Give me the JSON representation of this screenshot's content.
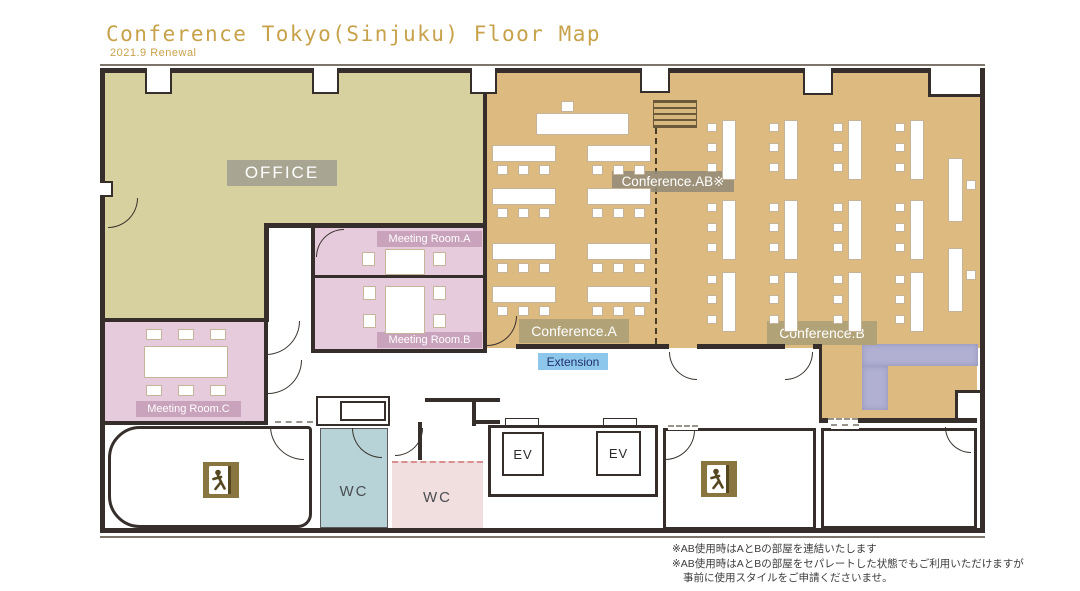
{
  "header": {
    "title": "Conference Tokyo(Sinjuku) Floor Map",
    "subtitle": "2021.9 Renewal"
  },
  "rooms": {
    "office": {
      "label": "OFFICE"
    },
    "conference_ab": {
      "label": "Conference.AB※"
    },
    "conference_a": {
      "label": "Conference.A"
    },
    "conference_b": {
      "label": "Conference.B"
    },
    "extension": {
      "label": "Extension"
    },
    "meeting_room_a": {
      "label": "Meeting Room.A"
    },
    "meeting_room_b": {
      "label": "Meeting Room.B"
    },
    "meeting_room_c": {
      "label": "Meeting Room.C"
    },
    "wc_left": {
      "label": "WC"
    },
    "wc_right": {
      "label": "WC"
    },
    "elevator_1": {
      "label": "EV"
    },
    "elevator_2": {
      "label": "EV"
    }
  },
  "notes": {
    "line1": "※AB使用時はAとBの部屋を連結いたします",
    "line2": "※AB使用時はAとBの部屋をセパレートした状態でもご利用いただけますが",
    "line3": "事前に使用スタイルをご申請くださいませ。"
  },
  "colors": {
    "title_gold": "#c7a24b",
    "wall": "#352e2a",
    "office_fill": "#d7d19f",
    "conference_fill": "#ddba80",
    "meeting_fill": "#e6cbdc",
    "meeting_badge": "#c9a2bc",
    "conference_badge": "#b2a277",
    "office_badge": "#a9a795",
    "extension_badge": "#8dc7eb",
    "wc_teal": "#b7d3d7",
    "wc_pink": "#f1dede",
    "sofa_purple": "#b1b0d2",
    "exit_icon_olive": "#887540"
  }
}
